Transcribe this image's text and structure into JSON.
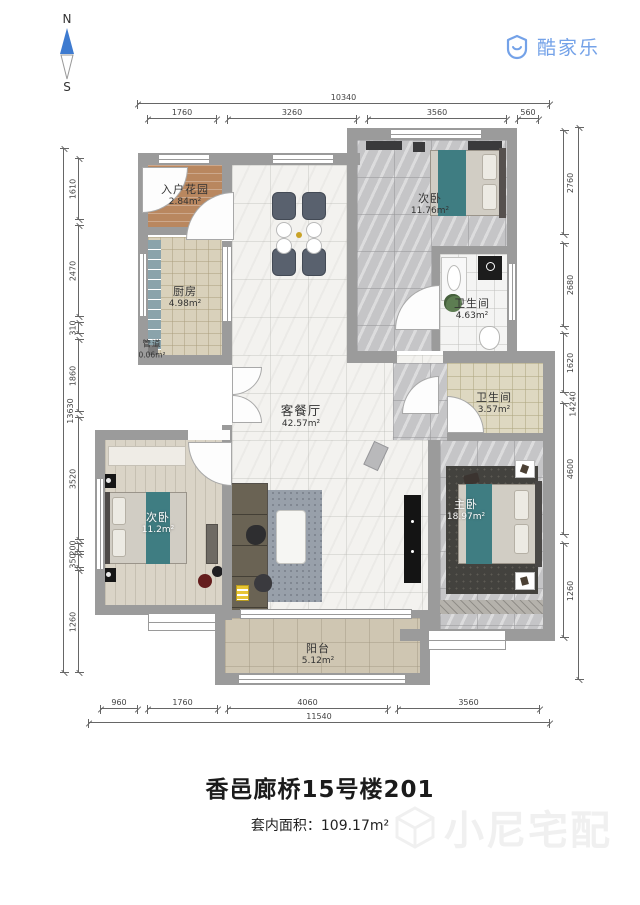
{
  "header": {
    "compass_n": "N",
    "compass_s": "S",
    "logo_text": "酷家乐"
  },
  "rooms": {
    "entry_garden": {
      "label": "入户花园",
      "area": "2.84m²"
    },
    "kitchen": {
      "label": "厨房",
      "area": "4.98m²"
    },
    "duct": {
      "label": "管道",
      "area": "0.06m²"
    },
    "living_dining": {
      "label": "客餐厅",
      "area": "42.57m²"
    },
    "bedroom_top": {
      "label": "次卧",
      "area": "11.76m²"
    },
    "bath_top": {
      "label": "卫生间",
      "area": "4.63m²"
    },
    "bath_mid": {
      "label": "卫生间",
      "area": "3.57m²"
    },
    "bedroom_left": {
      "label": "次卧",
      "area": "11.2m²"
    },
    "master": {
      "label": "主卧",
      "area": "18.97m²"
    },
    "balcony": {
      "label": "阳台",
      "area": "5.12m²"
    }
  },
  "dims": {
    "top": {
      "total": "10340",
      "segments": [
        "1760",
        "3260",
        "3560",
        "560"
      ]
    },
    "bottom": {
      "total": "11540",
      "segments": [
        "960",
        "1760",
        "4060",
        "3560"
      ]
    },
    "left": {
      "total": "13630",
      "segments": [
        "1610",
        "2470",
        "310",
        "1860",
        "3520",
        "200",
        "350",
        "1260"
      ]
    },
    "right": {
      "total": "14240",
      "segments": [
        "2760",
        "2680",
        "1620",
        "4600",
        "1260"
      ]
    }
  },
  "footer": {
    "title": "香邑廊桥15号楼201",
    "area_line": "套内面积：109.17m²",
    "watermark": "小尼宅配"
  },
  "colors": {
    "brand_blue": "#74a2e8",
    "wall_gray": "#9b9b9b",
    "teal_bedding": "#3f7d82"
  }
}
